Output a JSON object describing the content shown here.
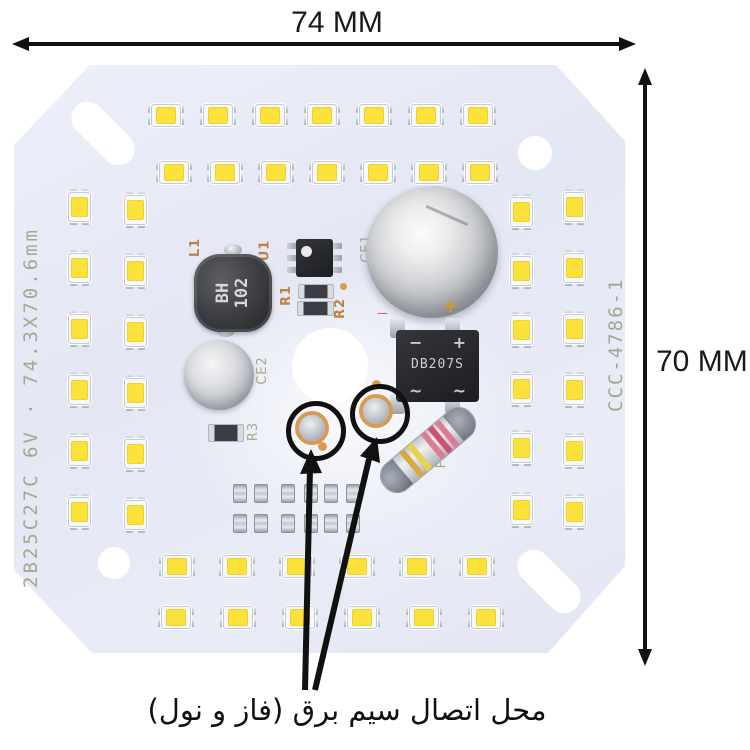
{
  "annotations": {
    "width_label": "74 MM",
    "height_label": "70 MM",
    "caption": "محل اتصال سیم برق (فاز و نول)"
  },
  "pcb": {
    "silkscreen_left": "2B25C27C 6V · 74.3X70.6mm",
    "silkscreen_right": "CCC-4786-1",
    "labels": {
      "l1": "L1",
      "u1": "U1",
      "r1": "R1",
      "r2": "R2",
      "r3": "R3",
      "ce1": "CE1",
      "ce2": "CE2",
      "f1": "F1"
    },
    "inductor_marking": [
      "BH",
      "102"
    ],
    "bridge": {
      "part": "DB207S",
      "minus": "−",
      "plus": "+",
      "ac": "~"
    },
    "polarity_plus": "+",
    "polarity_minus": "−−",
    "colors": {
      "board": "#e4e7f4",
      "led_yellow": "#fbe23b",
      "silkscreen_olive": "#a8a88e",
      "silkscreen_orange": "#c08144",
      "annotation_black": "#111111",
      "solder_ring_orange": "#d89a52"
    },
    "leds": {
      "groups": [
        {
          "name": "top-row-1",
          "orient": "h",
          "y": 115,
          "xs": [
            166,
            218,
            270,
            322,
            374,
            426,
            478
          ]
        },
        {
          "name": "top-row-2",
          "orient": "h",
          "y": 172,
          "xs": [
            174,
            225,
            276,
            327,
            378,
            429,
            480
          ]
        },
        {
          "name": "bottom-row-1",
          "orient": "h",
          "y": 566,
          "xs": [
            177,
            237,
            297,
            357,
            417,
            477
          ]
        },
        {
          "name": "bottom-row-2",
          "orient": "h",
          "y": 617,
          "xs": [
            176,
            238,
            300,
            362,
            424,
            486
          ]
        },
        {
          "name": "left-col-outer",
          "orient": "v",
          "x": 79,
          "ys": [
            207,
            268,
            329,
            390,
            451,
            512
          ]
        },
        {
          "name": "left-col-inner",
          "orient": "v",
          "x": 135,
          "ys": [
            210,
            271,
            332,
            393,
            454,
            515
          ]
        },
        {
          "name": "right-col-inner",
          "orient": "v",
          "x": 521,
          "ys": [
            212,
            271,
            330,
            389,
            448,
            510
          ]
        },
        {
          "name": "right-col-outer",
          "orient": "v",
          "x": 574,
          "ys": [
            207,
            268,
            329,
            390,
            451,
            512
          ]
        }
      ]
    },
    "smd_cluster": {
      "rows": [
        492,
        522
      ],
      "xs": [
        239,
        260,
        287,
        310,
        330,
        352
      ]
    }
  }
}
